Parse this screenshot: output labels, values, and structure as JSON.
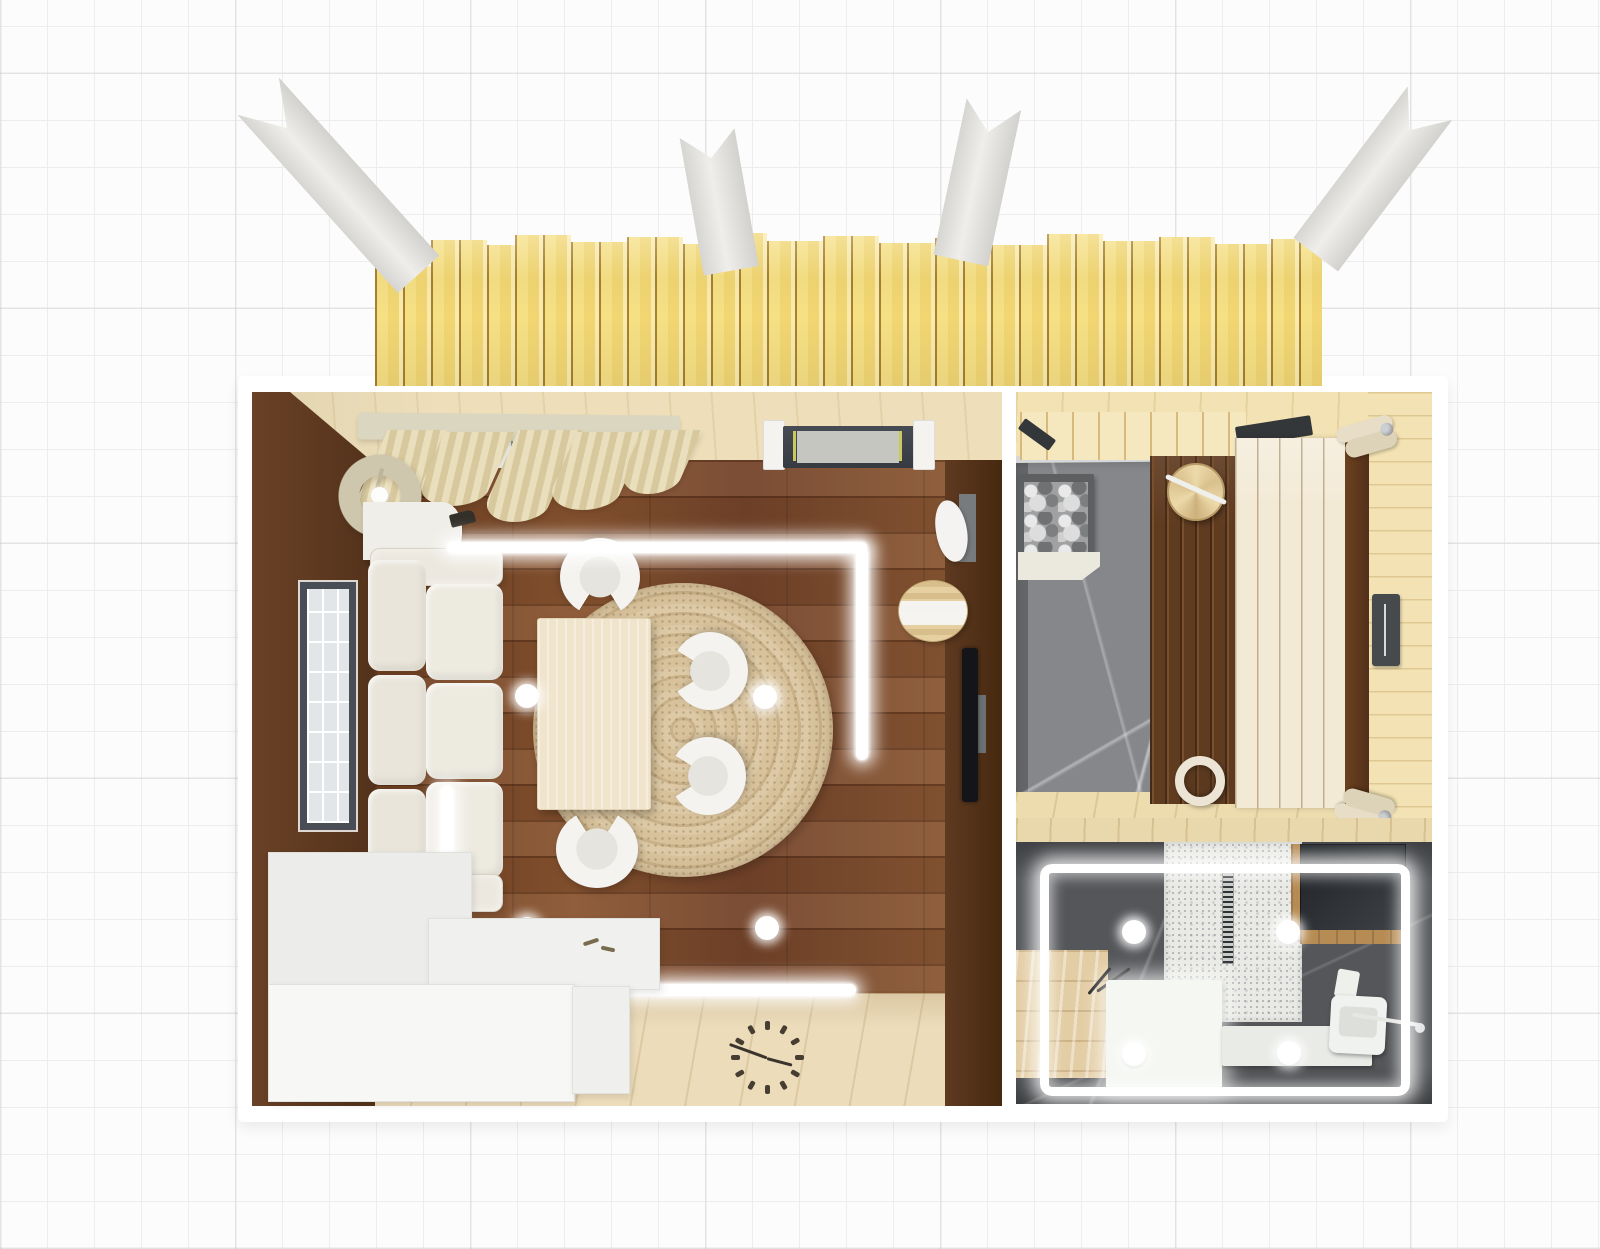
{
  "app": {
    "name": "3d-floorplan-top-view",
    "view_mode": "top-down render over blueprint grid"
  },
  "palette": {
    "grid": "#ededed",
    "bg": "#fcfcfc",
    "deck_wood": "#f5dd84",
    "deck_gap": "#a8802e",
    "beam": "#e6e5e1",
    "wall_brown": "#5d3a22",
    "wall_beige": "#eedfba",
    "wall_pine": "#f3e3b4",
    "floor_walnut": "#7b4a2b",
    "floor_birch": "#ecdcba",
    "stone_light": "#85878a",
    "stone_dark": "#54565a",
    "led": "#ffffff",
    "sofa": "#ece8df",
    "rug": "#d2bc96",
    "table": "#f0e5cc",
    "bench_dark": "#5f3b20",
    "bench_light": "#f3ead6",
    "shower": "#e9e9e5",
    "vanity": "#e3cda4"
  },
  "scene": {
    "areas": [
      {
        "id": "terrace-deck",
        "description": "outdoor deck with vertical pine planks",
        "roof_beams": 4
      },
      {
        "id": "living-room",
        "walls": {
          "left": "dark brown",
          "top": "beige wood",
          "right": "dark brown"
        },
        "floors": {
          "main": "dark walnut planks",
          "bottom": "light birch planks"
        },
        "items": [
          "window",
          "pelmet",
          "curtains",
          "entry-door",
          "floor-lamp",
          "console-table",
          "sofa",
          "dining-table",
          "dining-chair x4",
          "round-jute-rug",
          "led-strip x4",
          "floor-light-sphere x4",
          "vase",
          "wooden-stool",
          "wall-tv",
          "storage-bench-steps",
          "wall-clock"
        ]
      },
      {
        "id": "sauna",
        "walls": {
          "top": "pine",
          "right": "pine"
        },
        "floor": "grey marble + pine edge",
        "items": [
          "glass-door",
          "door-track",
          "backrest-planks",
          "heater-with-stones",
          "lower-bench-dark",
          "upper-bench-light",
          "wooden-bucket",
          "wooden-barrel",
          "headrest x2",
          "control-panel"
        ]
      },
      {
        "id": "bathroom",
        "floor": "dark grey marble",
        "items": [
          "led-perimeter",
          "shower-tray",
          "linear-drain",
          "dark-glass-panel",
          "wood-trim",
          "vanity-counter",
          "sink-cabinet",
          "bench",
          "wall-hung-toilet",
          "towel-bar",
          "ceiling-spot x4"
        ]
      }
    ],
    "counts": {
      "roof_beams": 4,
      "dining_chairs": 4,
      "floor_spheres": 4,
      "bathroom_spots": 4,
      "sauna_headrests": 2
    }
  }
}
